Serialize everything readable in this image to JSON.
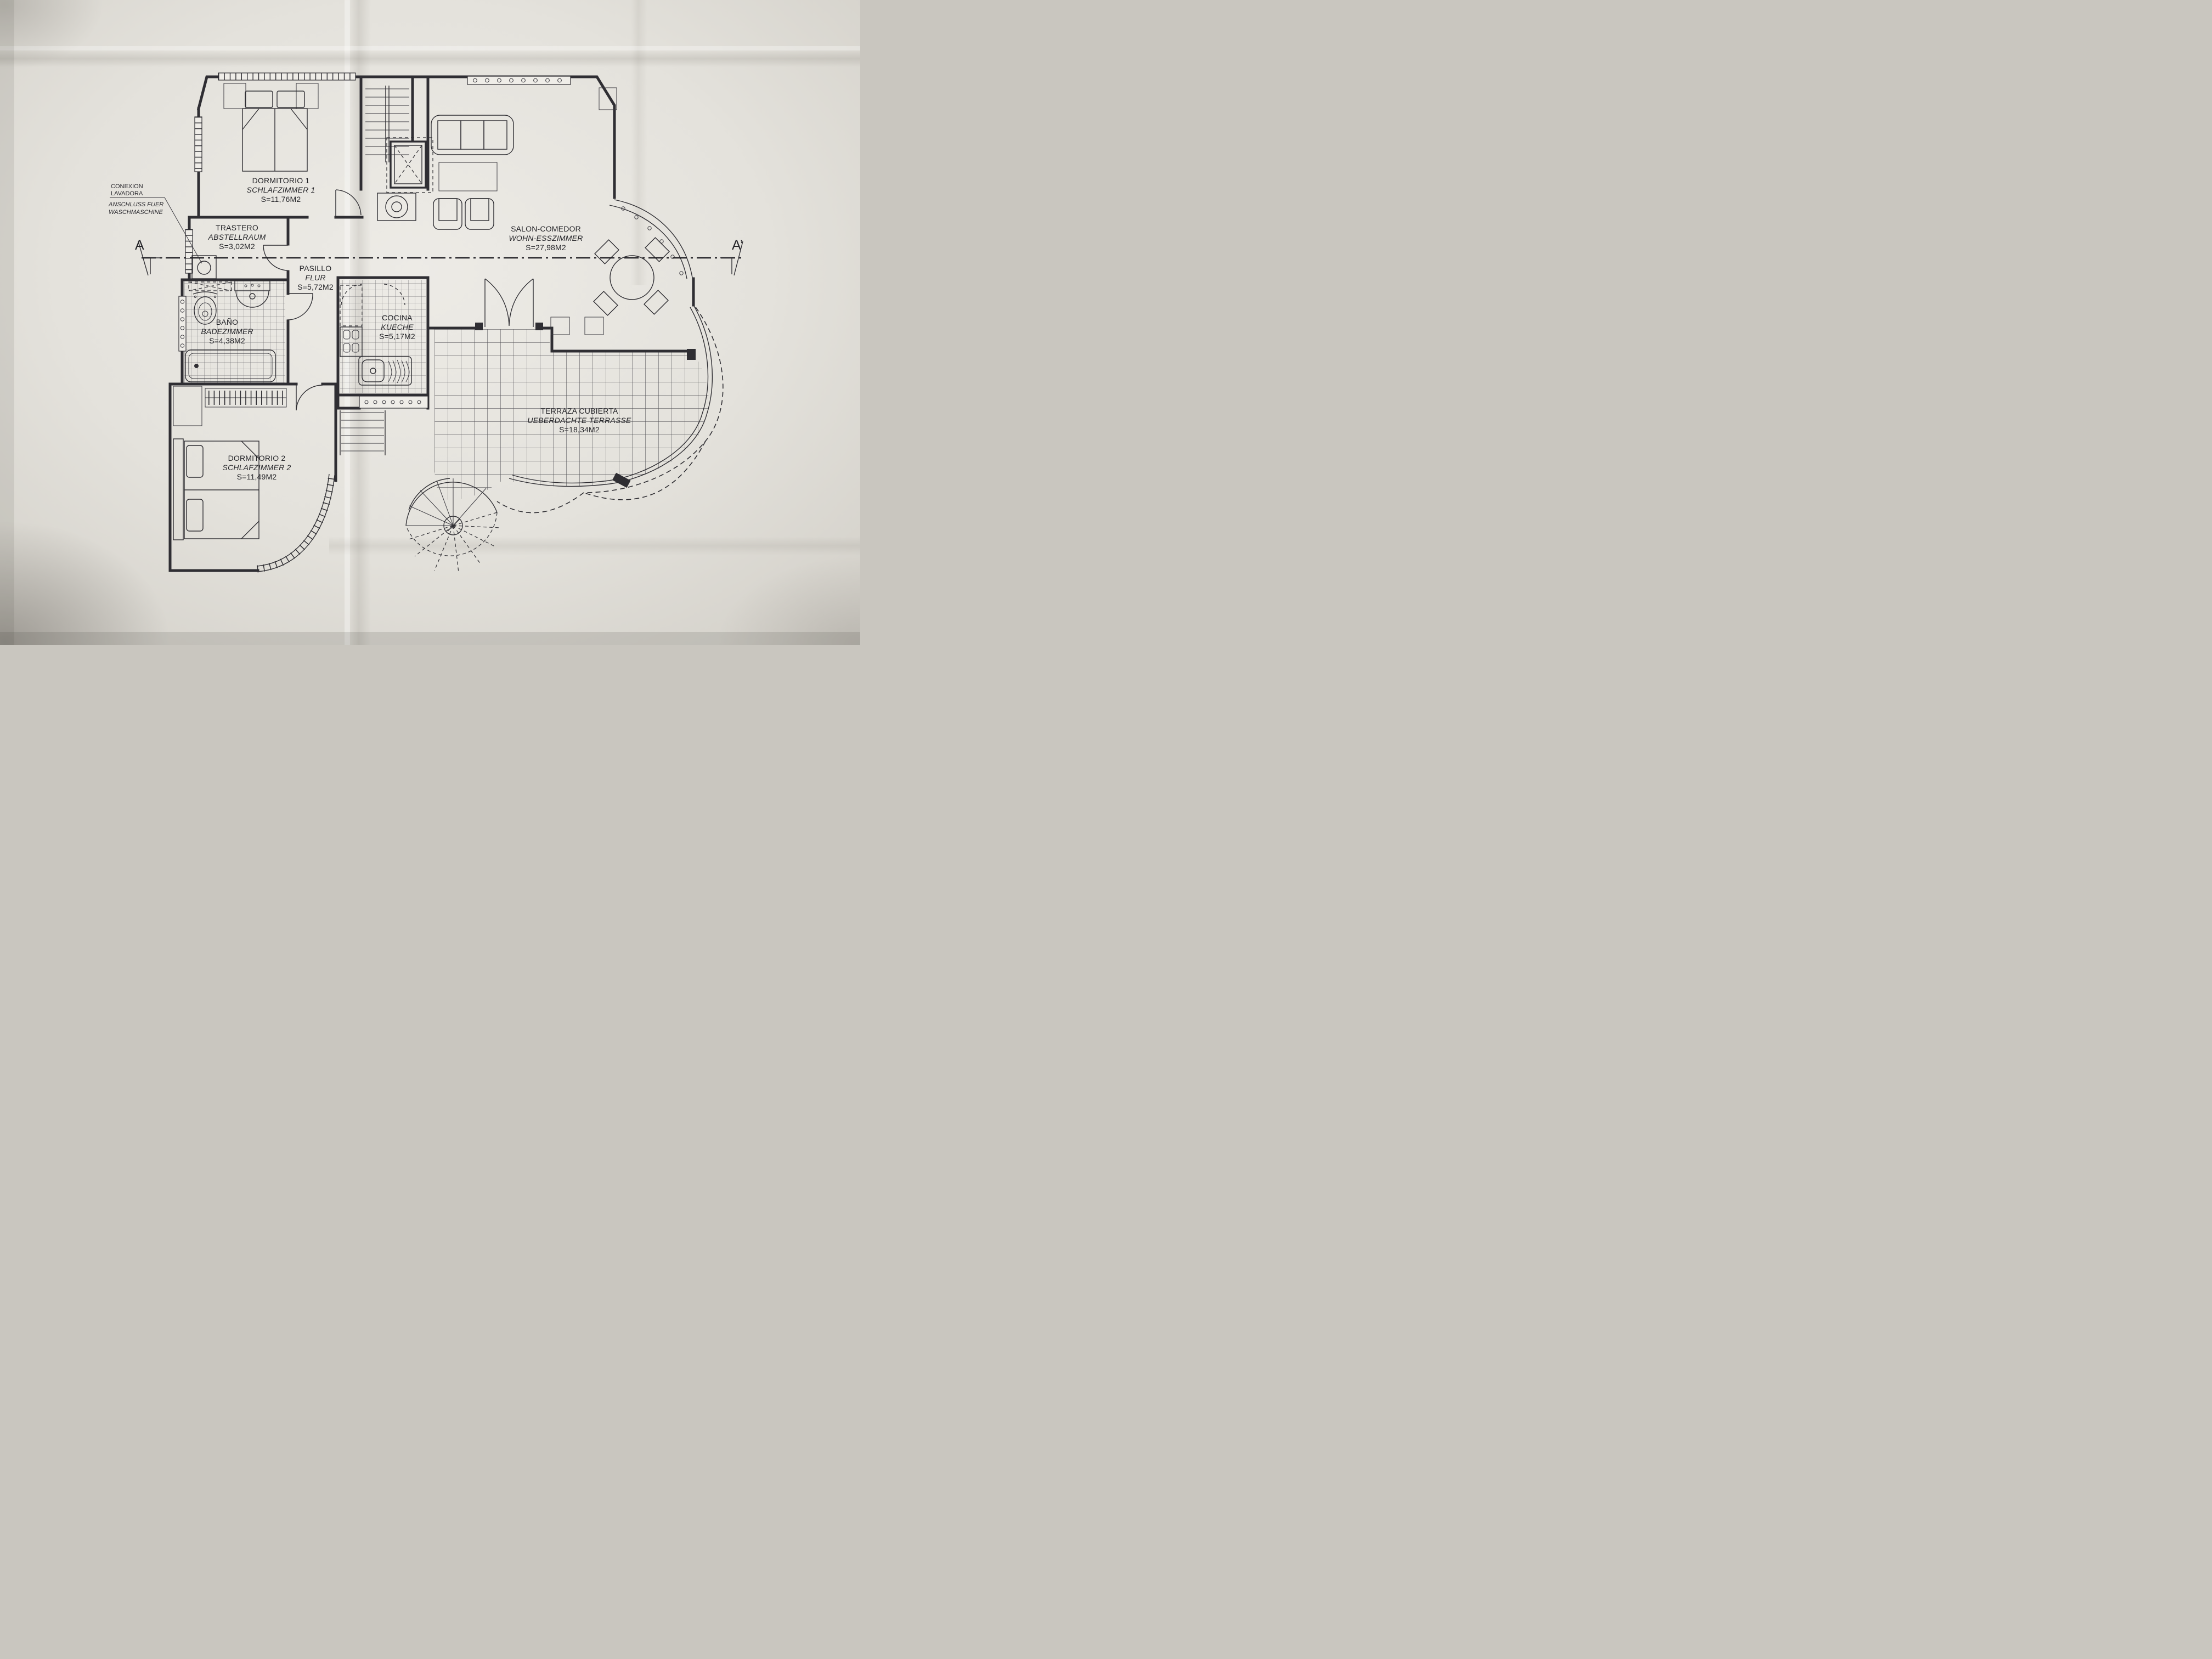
{
  "document": {
    "kind": "architectural floor plan photo"
  },
  "rooms": {
    "dormitorio1": {
      "name": "DORMITORIO 1",
      "name_alt": "SCHLAFZIMMER 1",
      "area": "S=11,76M2"
    },
    "trastero": {
      "name": "TRASTERO",
      "name_alt": "ABSTELLRAUM",
      "area": "S=3,02M2"
    },
    "pasillo": {
      "name": "PASILLO",
      "name_alt": "FLUR",
      "area": "S=5,72M2"
    },
    "bano": {
      "name": "BAÑO",
      "name_alt": "BADEZIMMER",
      "area": "S=4,38M2"
    },
    "cocina": {
      "name": "COCINA",
      "name_alt": "KUECHE",
      "area": "S=5,17M2"
    },
    "salon": {
      "name": "SALON-COMEDOR",
      "name_alt": "WOHN-ESSZIMMER",
      "area": "S=27,98M2"
    },
    "dormitorio2": {
      "name": "DORMITORIO 2",
      "name_alt": "SCHLAFZIMMER 2",
      "area": "S=11,49M2"
    },
    "terraza": {
      "name": "TERRAZA CUBIERTA",
      "name_alt": "UEBERDACHTE TERRASSE",
      "area": "S=18,34M2"
    }
  },
  "annotation": {
    "es_line1": "CONEXION",
    "es_line2": "LAVADORA",
    "de_line1": "ANSCHLUSS FUER",
    "de_line2": "WASCHMASCHINE"
  },
  "section_markers": {
    "left": "A",
    "right": "A’"
  },
  "colors": {
    "ink": "#2f2e33",
    "paper": "#e5e3dd"
  }
}
